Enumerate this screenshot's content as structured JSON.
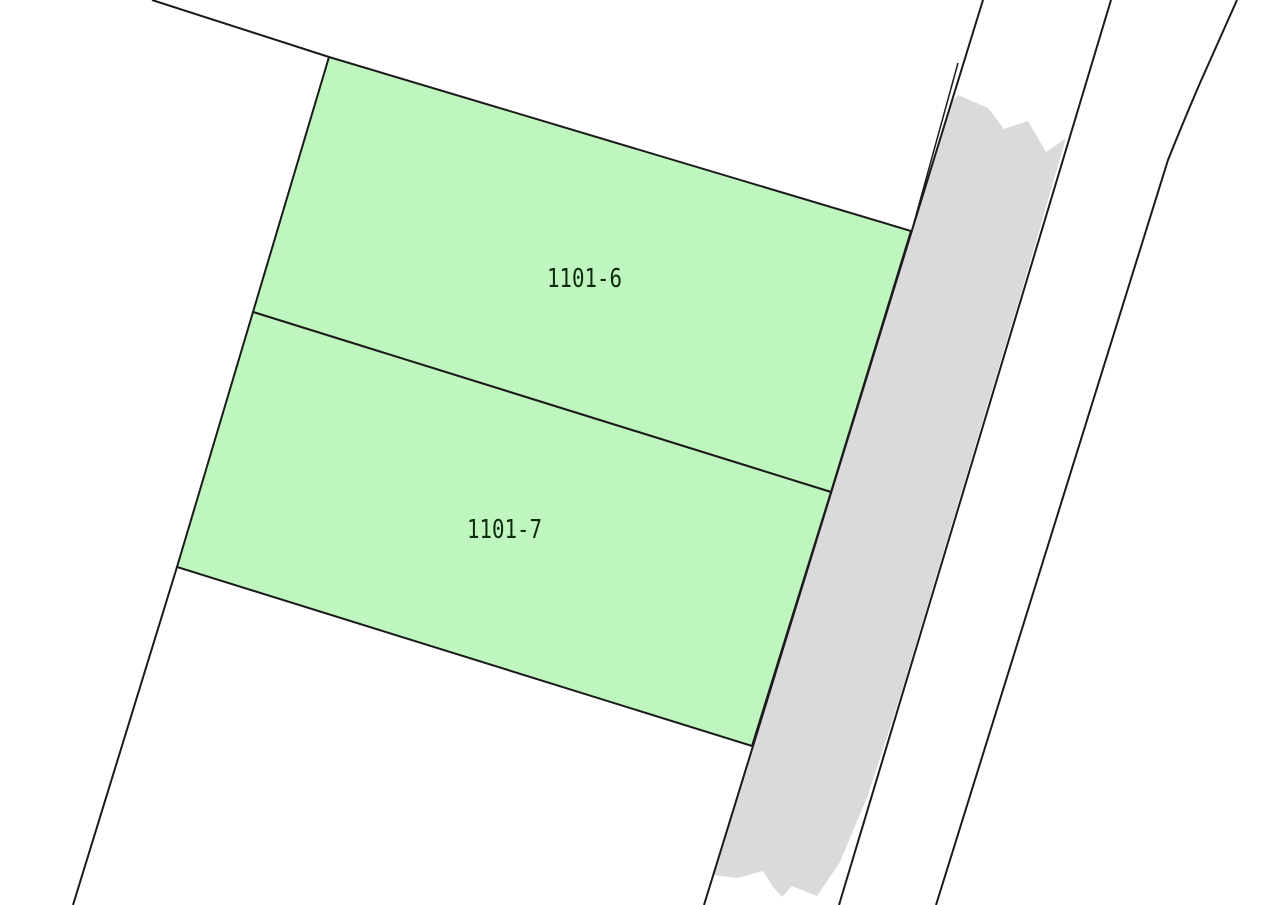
{
  "map": {
    "type": "cadastral-parcel-map",
    "background": "#ffffff",
    "line_color": "#1b1b1b",
    "parcel_fill": "#bff5be",
    "road_fill": "#dadada",
    "label_color": "#0d2a0d",
    "parcels": [
      {
        "label": "1101-6"
      },
      {
        "label": "1101-7"
      }
    ]
  }
}
